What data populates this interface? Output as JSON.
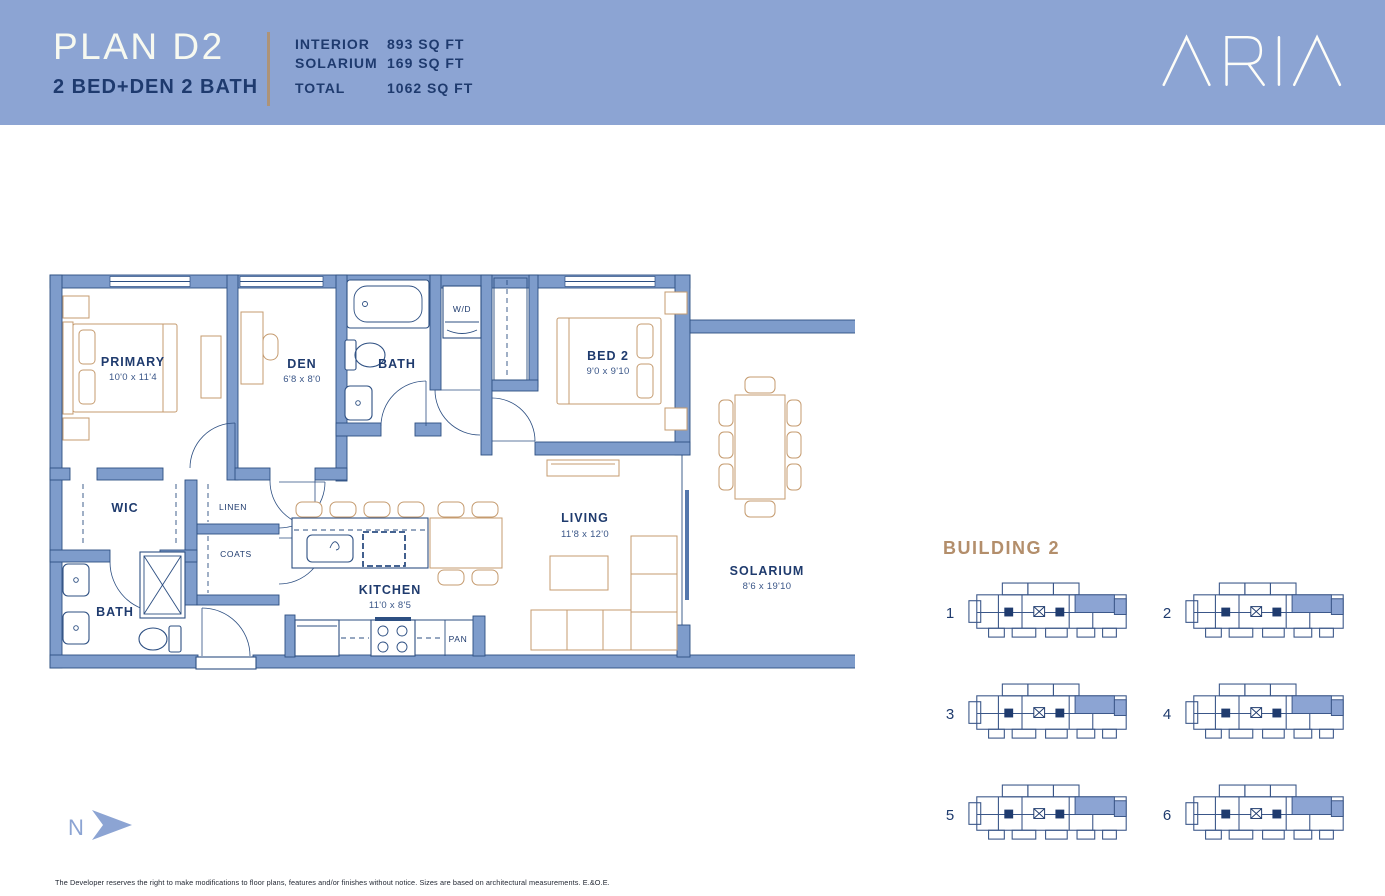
{
  "header": {
    "plan_name": "PLAN D2",
    "plan_type": "2 BED+DEN 2 BATH",
    "brand": "ARIA",
    "stats": [
      {
        "label": "INTERIOR",
        "value": "893 SQ FT"
      },
      {
        "label": "SOLARIUM",
        "value": "169 SQ FT"
      },
      {
        "label": "TOTAL",
        "value": "1062 SQ FT"
      }
    ],
    "colors": {
      "band_bg": "#8CA4D3",
      "title_text": "#F7F9F0",
      "subtitle_text": "#1E3A6E",
      "divider": "#AD9378"
    }
  },
  "floorplan": {
    "colors": {
      "wall_fill": "#7E9CCB",
      "wall_line": "#2D4F82",
      "furniture_line": "#C59B6F",
      "label_text": "#1F3B6E",
      "highlight": "#8CA4D3"
    },
    "rooms": {
      "primary": {
        "name": "PRIMARY",
        "dim": "10'0 x 11'4"
      },
      "den": {
        "name": "DEN",
        "dim": "6'8 x 8'0"
      },
      "bath_main": {
        "name": "BATH"
      },
      "wd": {
        "name": "W/D"
      },
      "bed2": {
        "name": "BED 2",
        "dim": "9'0 x 9'10"
      },
      "wic": {
        "name": "WIC"
      },
      "linen": {
        "name": "LINEN"
      },
      "coats": {
        "name": "COATS"
      },
      "bath_ensuite": {
        "name": "BATH"
      },
      "kitchen": {
        "name": "KITCHEN",
        "dim": "11'0 x 8'5"
      },
      "pan": {
        "name": "PAN"
      },
      "living": {
        "name": "LIVING",
        "dim": "11'8 x 12'0"
      },
      "solarium": {
        "name": "SOLARIUM",
        "dim": "8'6 x 19'10"
      }
    }
  },
  "keyplans": {
    "heading": "BUILDING 2",
    "items": [
      {
        "number": "1"
      },
      {
        "number": "2"
      },
      {
        "number": "3"
      },
      {
        "number": "4"
      },
      {
        "number": "5"
      },
      {
        "number": "6"
      }
    ]
  },
  "compass": {
    "label": "N"
  },
  "footer": {
    "disclaimer": "The Developer reserves the right to make modifications to floor plans, features and/or finishes without notice. Sizes are based on architectural measurements. E.&O.E."
  }
}
